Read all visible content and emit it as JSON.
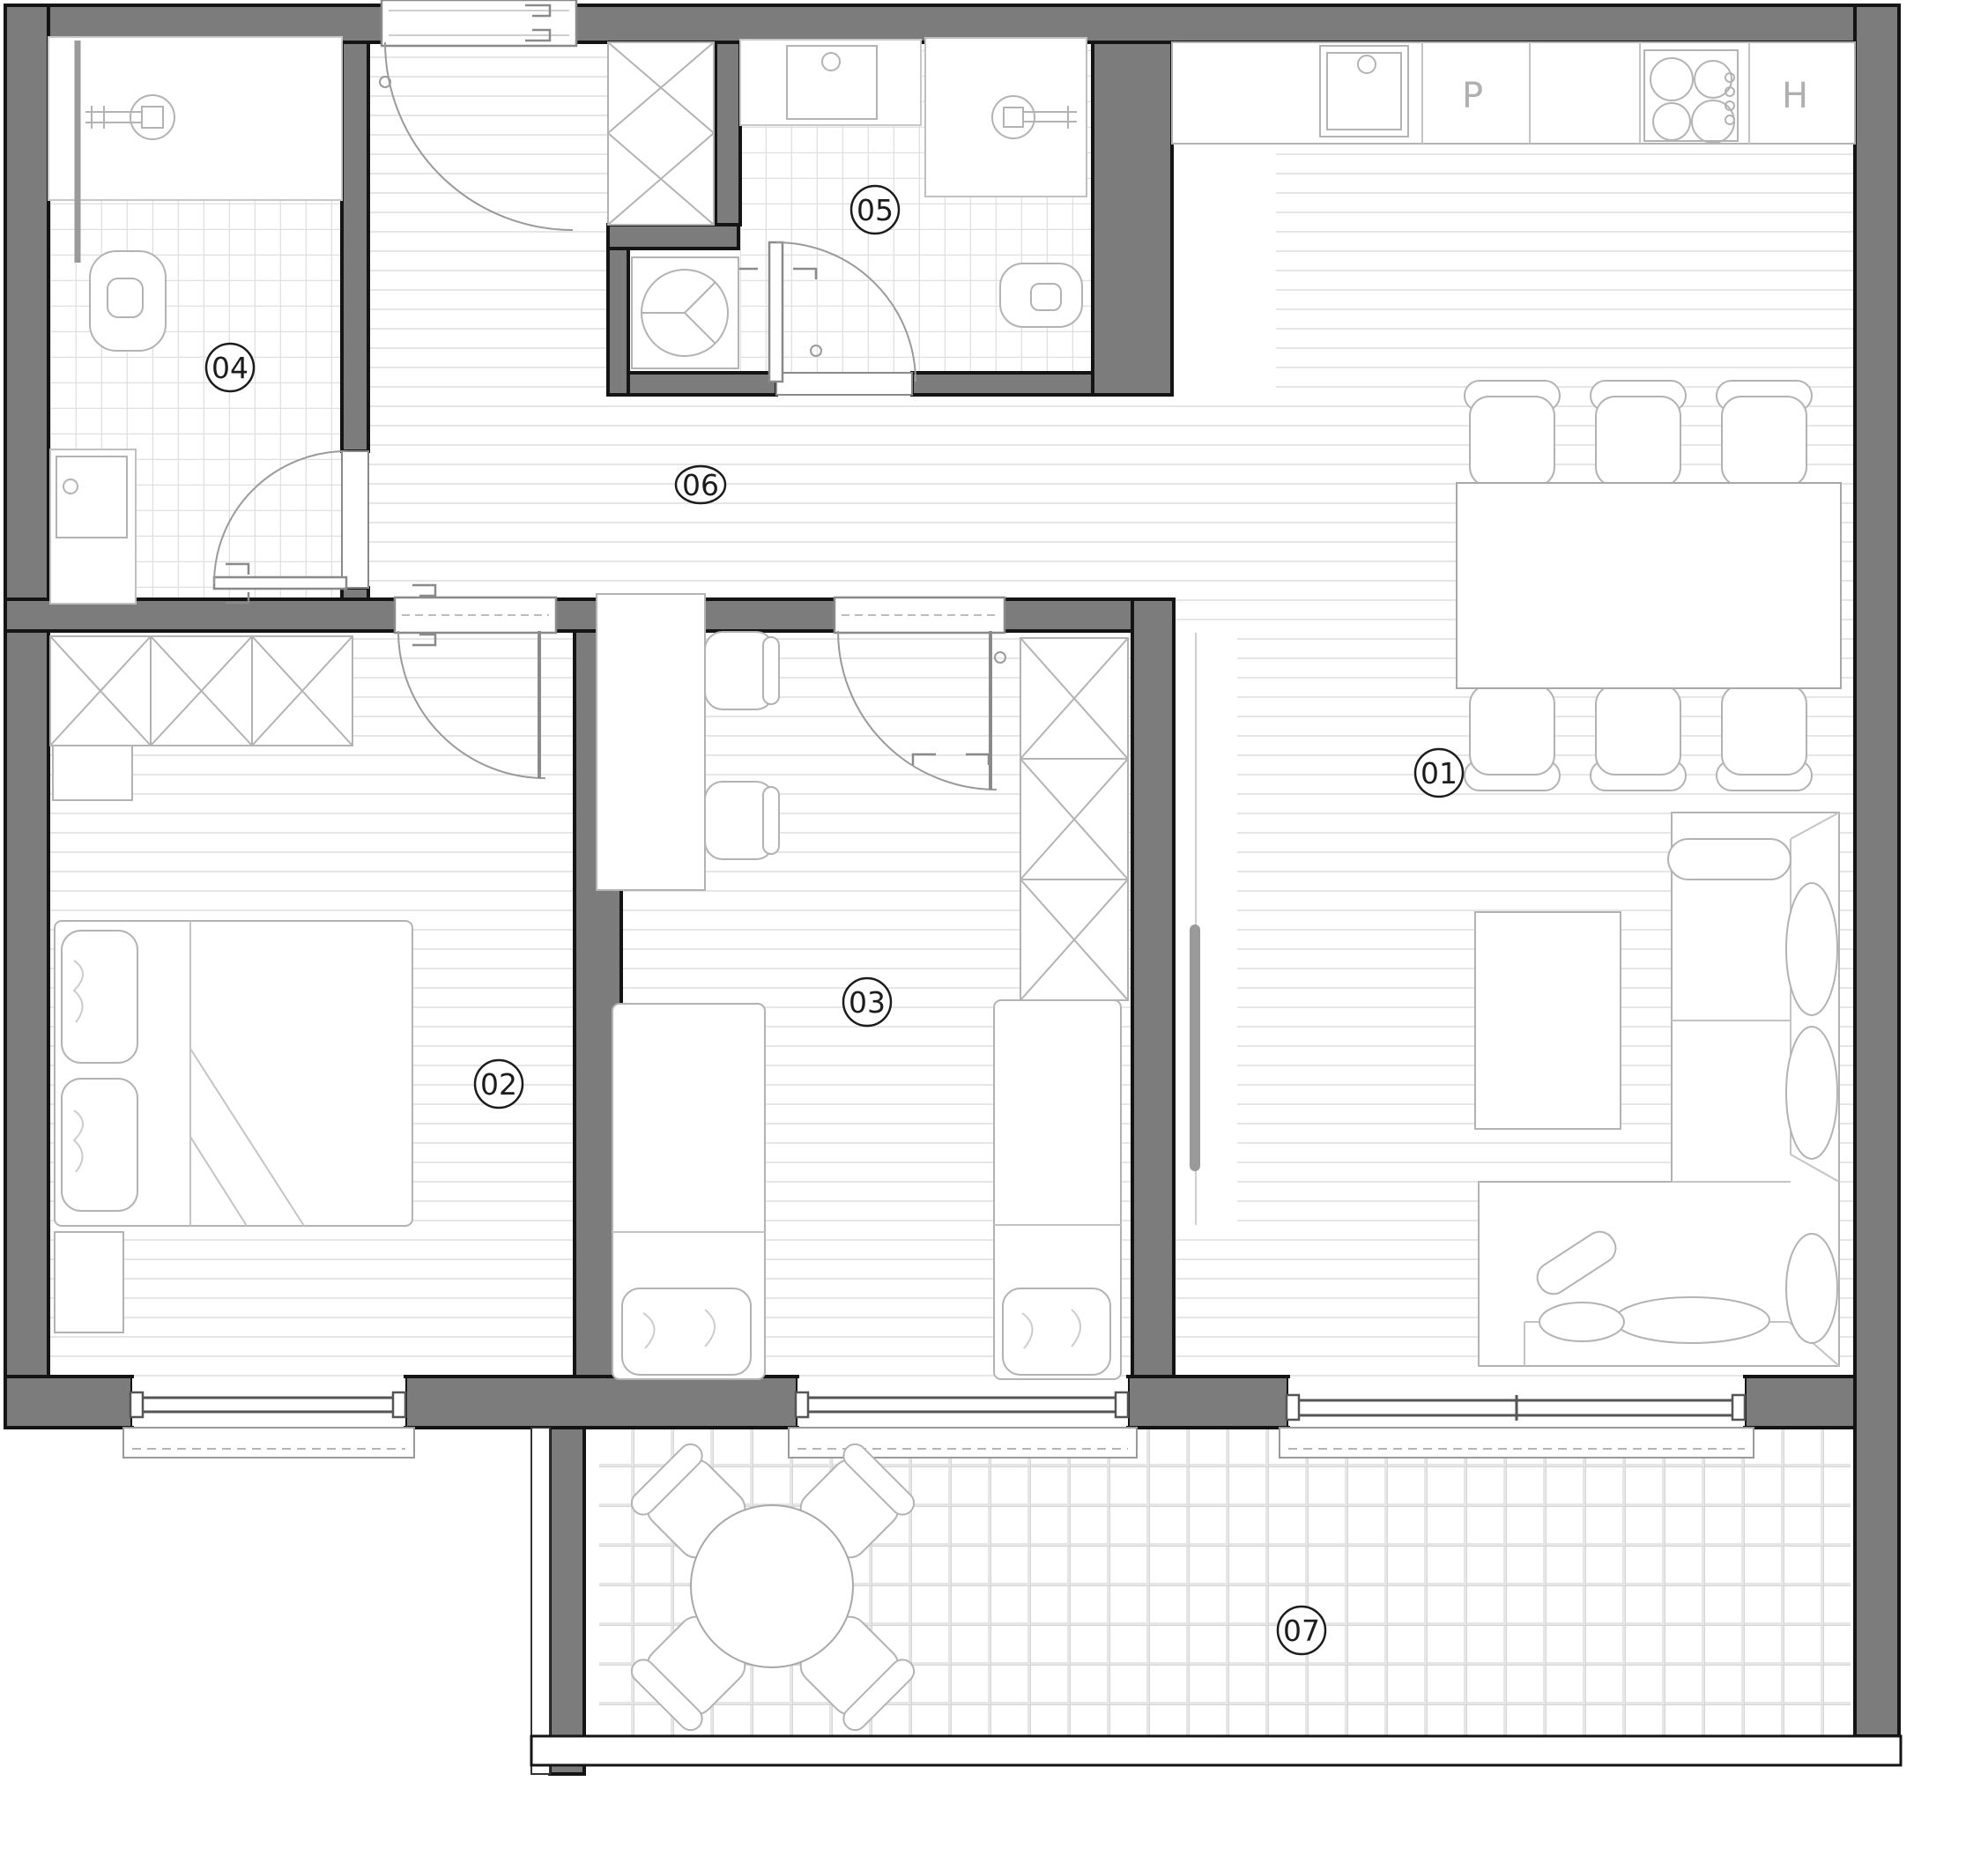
{
  "title": "apartment-floor-plan",
  "colors": {
    "wall": "#7c7c7c",
    "outline": "#141414",
    "furniture_stroke": "#b3b3b3",
    "floor_line": "#e6e6e6",
    "tile_line": "#e0e0e0",
    "letter_gray": "#b0b0b0"
  },
  "rooms": [
    {
      "id": "01",
      "label": "01",
      "name": "living-room-with-kitchen"
    },
    {
      "id": "02",
      "label": "02",
      "name": "bedroom"
    },
    {
      "id": "03",
      "label": "03",
      "name": "children-room"
    },
    {
      "id": "04",
      "label": "04",
      "name": "bathroom"
    },
    {
      "id": "05",
      "label": "05",
      "name": "bathroom-wc"
    },
    {
      "id": "06",
      "label": "06",
      "name": "hallway"
    },
    {
      "id": "07",
      "label": "07",
      "name": "terrace"
    }
  ],
  "kitchen": {
    "letters": [
      {
        "text": "P",
        "name": "counter-cell-p"
      },
      {
        "text": "H",
        "name": "counter-cell-h"
      }
    ]
  }
}
